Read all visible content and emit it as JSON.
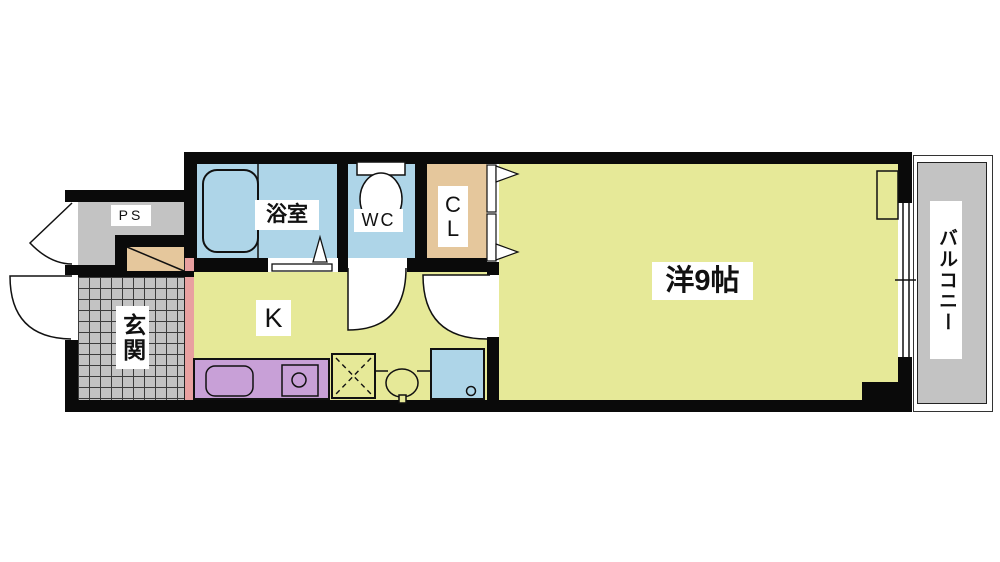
{
  "rooms": {
    "ps": {
      "label": "PS"
    },
    "genkan": {
      "label": "玄関"
    },
    "bathroom": {
      "label": "浴室"
    },
    "wc": {
      "label": "WC"
    },
    "closet": {
      "char_top": "C",
      "char_bottom": "L"
    },
    "kitchen": {
      "label": "K"
    },
    "western_room": {
      "label": "洋9帖"
    },
    "balcony": {
      "label": "バルコニー"
    }
  },
  "colors": {
    "wall": "#0a0a0a",
    "room-yellow": "#e6e998",
    "water-blue": "#aed5e8",
    "closet-tan": "#e5c79c",
    "counter-purple": "#c8a0d7",
    "step-pink": "#e9a0a0",
    "floor-gray": "#c3c3c3",
    "label-bg": "#ffffff"
  }
}
